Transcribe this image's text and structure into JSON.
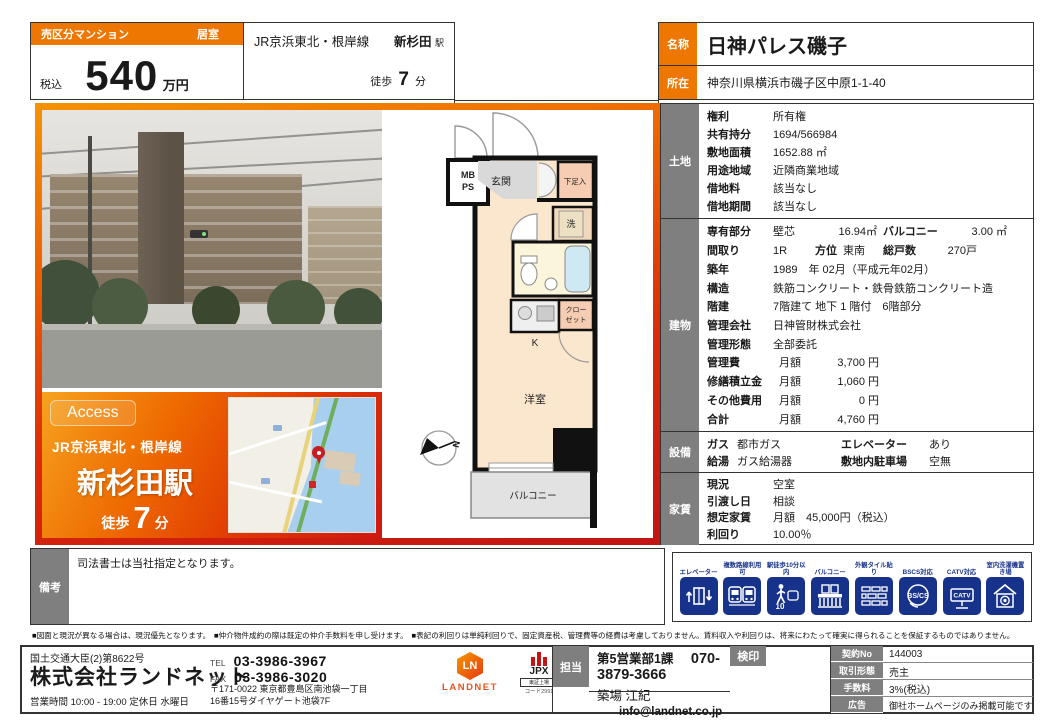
{
  "header": {
    "category": "売区分マンション",
    "room_use": "居室",
    "tax": "税込",
    "price": "540",
    "unit": "万円",
    "line1": {
      "name": "JR京浜東北・根岸線",
      "station": "新杉田",
      "suffix": "駅",
      "walk": "徒歩",
      "minutes": "7",
      "min_unit": "分"
    },
    "line2": {
      "name": "京急本線",
      "station": "屏風浦",
      "suffix": "",
      "walk": "徒歩",
      "minutes": "10",
      "min_unit": "分"
    },
    "name_label": "名称",
    "property_name": "日神パレス磯子",
    "addr_label": "所在",
    "address": "神奈川県横浜市磯子区中原1-1-40"
  },
  "access_box": {
    "badge": "Access",
    "line": "JR京浜東北・根岸線",
    "station": "新杉田駅",
    "walk": "徒歩",
    "minutes": "7",
    "min_unit": "分"
  },
  "floorplan": {
    "entrance": "玄関",
    "mb": "MB",
    "ps": "PS",
    "shoebox": "下足入",
    "laundry": "洗",
    "kitchen": "K",
    "closet_l1": "クロー",
    "closet_l2": "ゼット",
    "room": "洋室",
    "balcony": "バルコニー",
    "compass": "N"
  },
  "details": {
    "land": {
      "label": "土地",
      "rows": [
        {
          "k": "権利",
          "v": "所有権"
        },
        {
          "k": "共有持分",
          "v": "1694/566984"
        },
        {
          "k": "敷地面積",
          "v": "1652.88 ㎡"
        },
        {
          "k": "用途地域",
          "v": "近隣商業地域"
        },
        {
          "k": "借地料",
          "v": "該当なし"
        },
        {
          "k": "借地期間",
          "v": "該当なし"
        }
      ]
    },
    "building": {
      "label": "建物",
      "area_row": {
        "k": "専有部分",
        "v1": "壁芯",
        "v2": "16.94㎡",
        "k2": "バルコニー",
        "v3": "3.00 ㎡"
      },
      "layout_row": {
        "k": "間取り",
        "v1": "1R",
        "k2": "方位",
        "v2": "東南",
        "k3": "総戸数",
        "v3": "270戸"
      },
      "rows": [
        {
          "k": "築年",
          "v": "1989　年 02月（平成元年02月）"
        },
        {
          "k": "構造",
          "v": "鉄筋コンクリート・鉄骨鉄筋コンクリート造"
        },
        {
          "k": "階建",
          "v": "7階建て 地下 1 階付　6階部分"
        },
        {
          "k": "管理会社",
          "v": "日神管財株式会社"
        },
        {
          "k": "管理形態",
          "v": "全部委託"
        }
      ],
      "fee_rows": [
        {
          "k": "管理費",
          "sub": "月額",
          "v": "3,700 円"
        },
        {
          "k": "修繕積立金",
          "sub": "月額",
          "v": "1,060 円"
        },
        {
          "k": "その他費用",
          "sub": "月額",
          "v": "0 円"
        },
        {
          "k": "合計",
          "sub": "月額",
          "v": "4,760 円"
        }
      ]
    },
    "facility": {
      "label": "設備",
      "rows": [
        {
          "k1": "ガス",
          "v1": "都市ガス",
          "k2": "エレベーター",
          "v2": "あり"
        },
        {
          "k1": "給湯",
          "v1": "ガス給湯器",
          "k2": "敷地内駐車場",
          "v2": "空無"
        }
      ]
    },
    "rent": {
      "label": "家賃",
      "rows": [
        {
          "k": "現況",
          "v": "空室"
        },
        {
          "k": "引渡し日",
          "v": "相談"
        },
        {
          "k": "想定家賃",
          "v": "月額　45,000円（税込）"
        },
        {
          "k": "利回り",
          "v": "10.00％"
        }
      ]
    }
  },
  "remarks": {
    "label": "備考",
    "text": "司法書士は当社指定となります。"
  },
  "icons": {
    "items": [
      {
        "label": "エレベーター"
      },
      {
        "label": "複数路線利用可"
      },
      {
        "label": "駅徒歩10分以内",
        "glyph_text": "10"
      },
      {
        "label": "バルコニー"
      },
      {
        "label": "外観タイル貼り"
      },
      {
        "label": "BSCS対応",
        "glyph_text": "BS/CS"
      },
      {
        "label": "CATV対応",
        "glyph_text": "CATV"
      },
      {
        "label": "室内洗濯機置き場"
      }
    ]
  },
  "disclaimer": "■図面と現況が異なる場合は、現況優先となります。　■仲介物件成約の際は既定の仲介手数料を申し受けます。　■表記の利回りは単純利回りで、固定資産税、管理費等の経費は考慮しておりません。賃料収入や利回りは、将来にわたって確実に得られることを保証するものではありません。",
  "footer": {
    "license": "国土交通大臣(2)第8622号",
    "company": "株式会社ランドネット",
    "hours": "営業時間 10:00 - 19:00 定休日 水曜日",
    "tel_label": "TEL",
    "tel": "03-3986-3967",
    "fax_label": "FAX",
    "fax": "03-3986-3020",
    "address1": "〒171-0022 東京都豊島区南池袋一丁目",
    "address2": "16番15号ダイヤゲート池袋7F",
    "landnet_mark": "LN",
    "landnet_name": "LANDNET",
    "jpx_name": "JPX",
    "jpx_sub": "東証上場",
    "jpx_code": "コード2991",
    "staff_label": "担当",
    "staff_dept": "第5営業部1課",
    "staff_phone": "070-3879-3666",
    "staff_name": "築場 江紀",
    "staff_email": "info@landnet.co.jp",
    "seal_label": "検印",
    "contract_label": "契約No",
    "contract_no": "144003",
    "deal_label": "取引形態",
    "deal_type": "売主",
    "fee_label": "手数料",
    "fee": "3%(税込)",
    "ad_label": "広告",
    "ad": "御社ホームページのみ掲載可能です"
  }
}
